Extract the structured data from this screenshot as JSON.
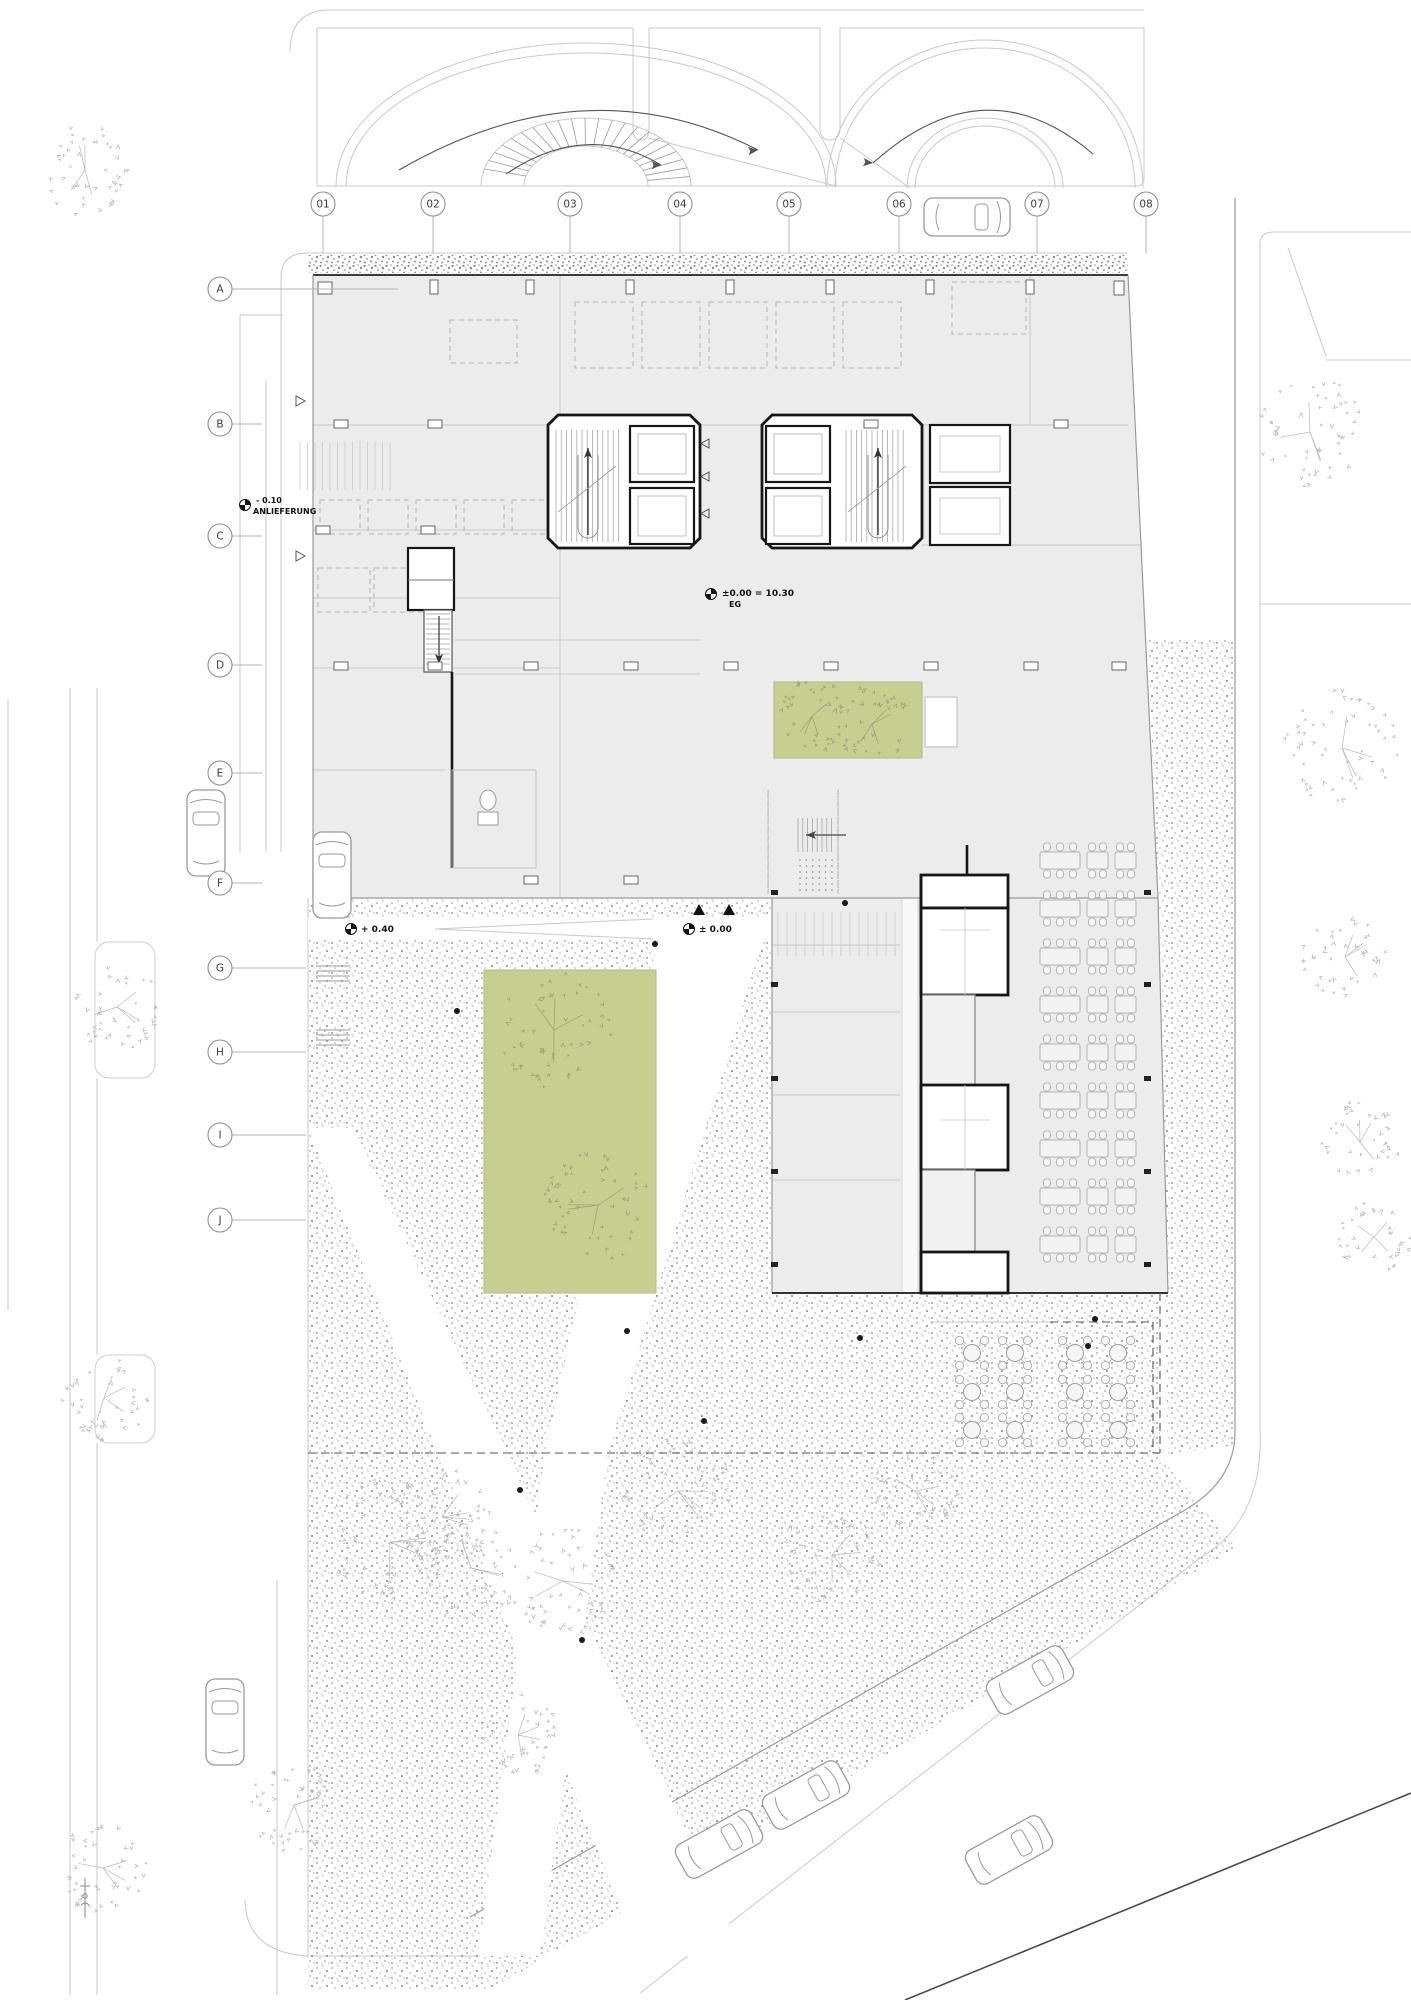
{
  "drawing": {
    "type": "architectural-floor-plan",
    "level_name": "EG"
  },
  "colors": {
    "building_fill": "#ececec",
    "green": "#c6ce90",
    "green_border": "#b2ba7e",
    "line_light": "#c9c9c9",
    "line_mid": "#9a9a9a",
    "line_dark": "#1c1c1c",
    "stipple": "#a0a0a0",
    "tree_gray": "#b9b9b9",
    "tree_on_green": "#97a077"
  },
  "grid": {
    "columns_y": 204,
    "columns": [
      {
        "label": "01",
        "x": 323
      },
      {
        "label": "02",
        "x": 433
      },
      {
        "label": "03",
        "x": 570
      },
      {
        "label": "04",
        "x": 680
      },
      {
        "label": "05",
        "x": 789
      },
      {
        "label": "06",
        "x": 899
      },
      {
        "label": "07",
        "x": 1037
      },
      {
        "label": "08",
        "x": 1146
      }
    ],
    "rows_x": 220,
    "rows": [
      {
        "label": "A",
        "y": 289
      },
      {
        "label": "B",
        "y": 424
      },
      {
        "label": "C",
        "y": 536
      },
      {
        "label": "D",
        "y": 665
      },
      {
        "label": "E",
        "y": 773
      },
      {
        "label": "F",
        "y": 883
      },
      {
        "label": "G",
        "y": 968
      },
      {
        "label": "H",
        "y": 1052
      },
      {
        "label": "I",
        "y": 1135
      },
      {
        "label": "J",
        "y": 1220
      }
    ]
  },
  "annotations": {
    "delivery": {
      "value": "- 0.10",
      "label": "ANLIEFERUNG"
    },
    "level": {
      "value": "±0.00 = 10.30",
      "label": "EG"
    },
    "plaza_high": {
      "value": "+ 0.40"
    },
    "plaza_zero": {
      "value": "± 0.00"
    }
  },
  "trees": [
    {
      "x": 85,
      "y": 170,
      "r": 45,
      "kind": "street"
    },
    {
      "x": 1310,
      "y": 432,
      "r": 55,
      "kind": "street"
    },
    {
      "x": 1342,
      "y": 748,
      "r": 58,
      "kind": "street"
    },
    {
      "x": 1345,
      "y": 957,
      "r": 42,
      "kind": "street"
    },
    {
      "x": 1360,
      "y": 1142,
      "r": 40,
      "kind": "street"
    },
    {
      "x": 1374,
      "y": 1237,
      "r": 36,
      "kind": "street"
    },
    {
      "x": 117,
      "y": 1007,
      "r": 44,
      "kind": "street"
    },
    {
      "x": 104,
      "y": 1398,
      "r": 43,
      "kind": "street"
    },
    {
      "x": 103,
      "y": 1868,
      "r": 46,
      "kind": "street"
    },
    {
      "x": 390,
      "y": 1542,
      "r": 66,
      "kind": "street"
    },
    {
      "x": 442,
      "y": 1517,
      "r": 50,
      "kind": "street"
    },
    {
      "x": 471,
      "y": 1568,
      "r": 52,
      "kind": "street"
    },
    {
      "x": 563,
      "y": 1581,
      "r": 55,
      "kind": "street"
    },
    {
      "x": 678,
      "y": 1491,
      "r": 55,
      "kind": "street"
    },
    {
      "x": 832,
      "y": 1555,
      "r": 50,
      "kind": "street"
    },
    {
      "x": 915,
      "y": 1491,
      "r": 42,
      "kind": "street"
    },
    {
      "x": 294,
      "y": 1805,
      "r": 46,
      "kind": "street"
    },
    {
      "x": 518,
      "y": 1735,
      "r": 40,
      "kind": "street"
    },
    {
      "x": 554,
      "y": 1030,
      "r": 58,
      "kind": "green"
    },
    {
      "x": 598,
      "y": 1205,
      "r": 55,
      "kind": "green"
    },
    {
      "x": 812,
      "y": 716,
      "r": 36,
      "kind": "green"
    },
    {
      "x": 872,
      "y": 724,
      "r": 38,
      "kind": "green"
    }
  ],
  "cars": [
    {
      "x": 967,
      "y": 217,
      "rot": 90
    },
    {
      "x": 206,
      "y": 833,
      "rot": 0
    },
    {
      "x": 332,
      "y": 875,
      "rot": 0
    },
    {
      "x": 225,
      "y": 1722,
      "rot": 0
    },
    {
      "x": 1030,
      "y": 1680,
      "rot": 61
    },
    {
      "x": 806,
      "y": 1795,
      "rot": 61
    },
    {
      "x": 719,
      "y": 1844,
      "rot": 61
    },
    {
      "x": 1009,
      "y": 1850,
      "rot": 61
    }
  ],
  "seating": {
    "x": 1040,
    "rows_y": [
      852,
      900,
      948,
      996,
      1044,
      1092,
      1140,
      1188,
      1236
    ]
  },
  "terrace": {
    "cols_x": [
      972,
      1015,
      1075,
      1118
    ],
    "rows_y": [
      1353,
      1392,
      1430
    ]
  },
  "plaza_dots": [
    [
      457,
      1011
    ],
    [
      627,
      1331
    ],
    [
      704,
      1421
    ],
    [
      860,
      1338
    ],
    [
      1095,
      1319
    ],
    [
      1088,
      1346
    ],
    [
      520,
      1490
    ],
    [
      582,
      1640
    ],
    [
      845,
      903
    ],
    [
      655,
      944
    ]
  ],
  "bike_racks": {
    "x": 316,
    "rows_y": [
      838,
      902,
      966,
      1030
    ]
  },
  "structural_columns": [
    [
      430,
      280,
      8,
      14
    ],
    [
      526,
      280,
      8,
      14
    ],
    [
      626,
      280,
      8,
      14
    ],
    [
      726,
      280,
      8,
      14
    ],
    [
      826,
      280,
      8,
      14
    ],
    [
      926,
      280,
      8,
      14
    ],
    [
      1026,
      280,
      8,
      14
    ],
    [
      318,
      282,
      14,
      12
    ],
    [
      1114,
      281,
      10,
      14
    ],
    [
      334,
      420,
      14,
      8
    ],
    [
      428,
      420,
      14,
      8
    ],
    [
      864,
      420,
      14,
      8
    ],
    [
      1054,
      420,
      14,
      8
    ],
    [
      316,
      526,
      14,
      8
    ],
    [
      421,
      526,
      14,
      8
    ],
    [
      334,
      662,
      14,
      8
    ],
    [
      428,
      662,
      14,
      8
    ],
    [
      524,
      662,
      14,
      8
    ],
    [
      624,
      662,
      14,
      8
    ],
    [
      724,
      662,
      14,
      8
    ],
    [
      824,
      662,
      14,
      8
    ],
    [
      924,
      662,
      14,
      8
    ],
    [
      1024,
      662,
      14,
      8
    ],
    [
      1112,
      662,
      14,
      8
    ],
    [
      334,
      876,
      14,
      8
    ],
    [
      524,
      876,
      14,
      8
    ],
    [
      624,
      876,
      14,
      8
    ]
  ],
  "overhang_columns_y": [
    890,
    982,
    1076,
    1169,
    1262
  ]
}
